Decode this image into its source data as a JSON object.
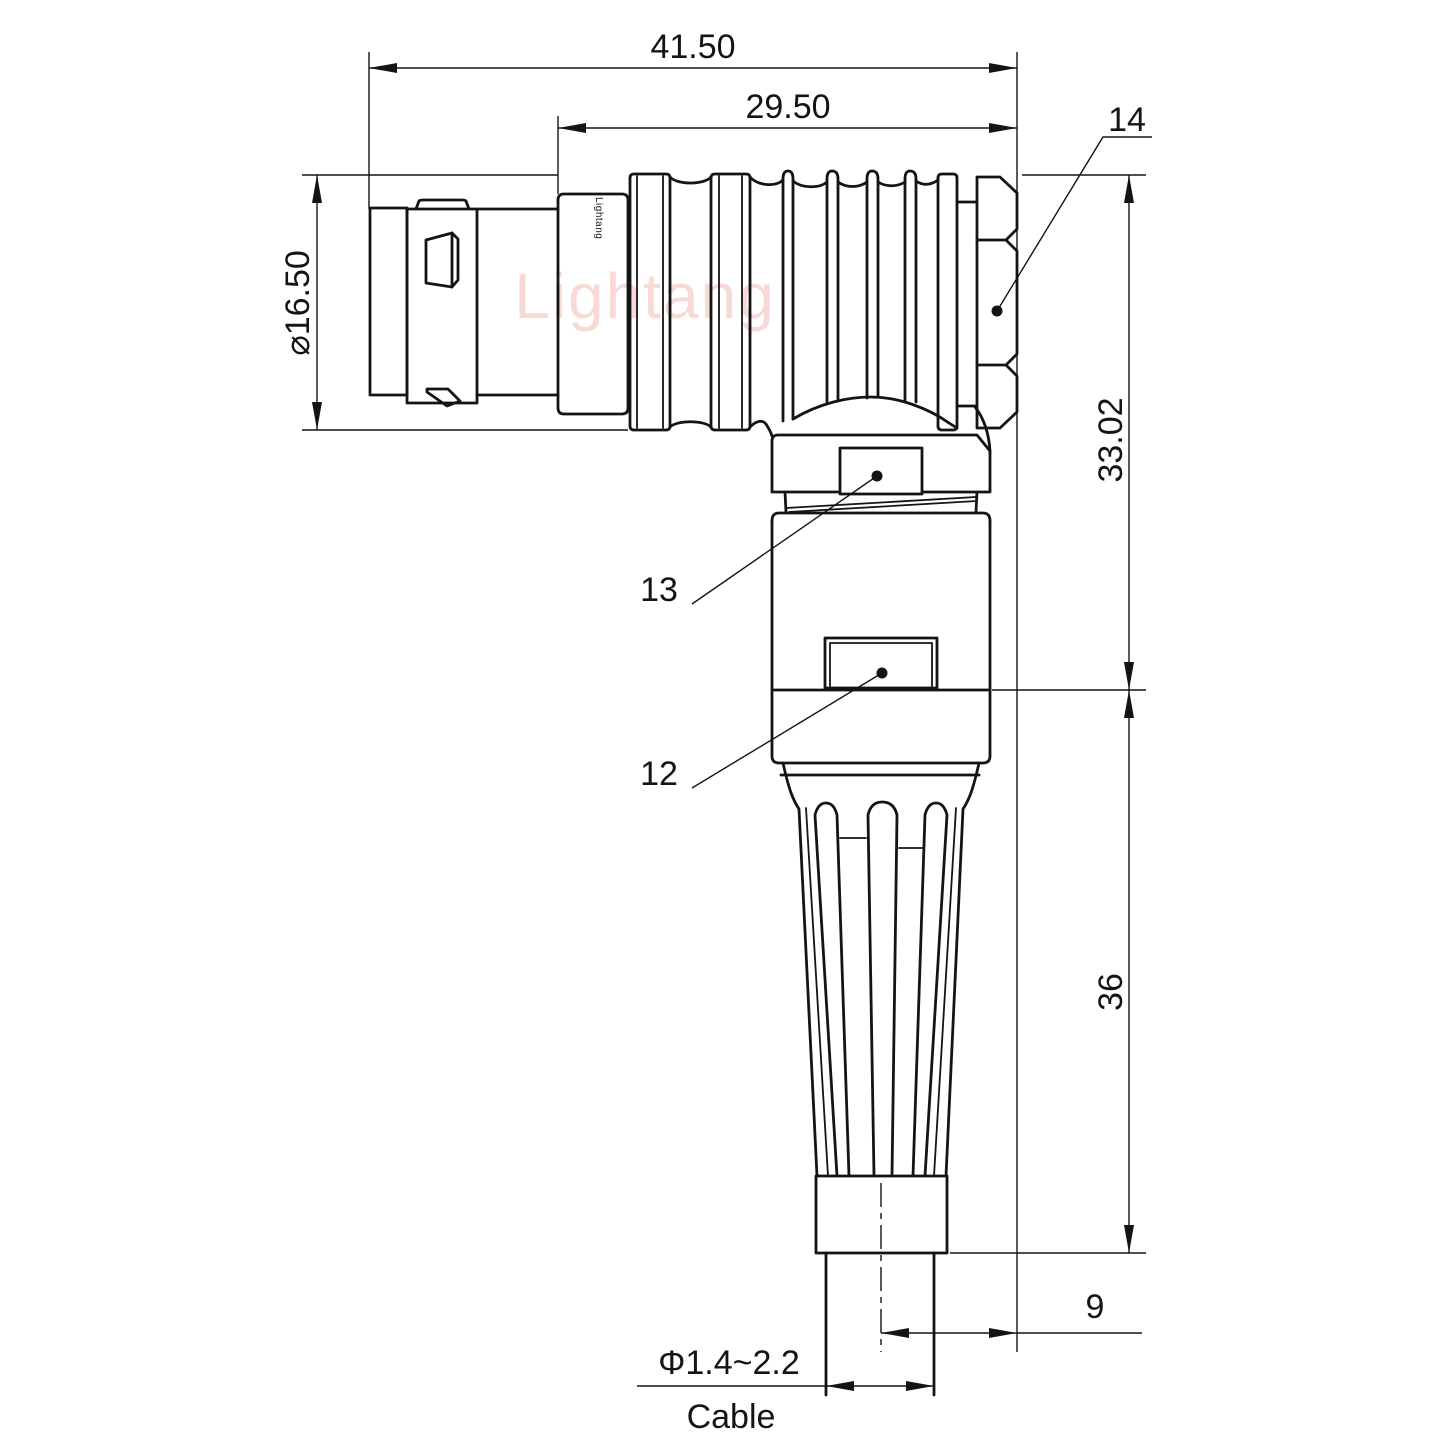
{
  "watermark": {
    "text": "Lightang"
  },
  "engraving": {
    "text": "Lightang"
  },
  "dims": {
    "overall_length": "41.50",
    "rear_length": "29.50",
    "plug_diameter": "⌀16.50",
    "upper_height": "33.02",
    "lower_height": "36",
    "cable_offset": "9",
    "cable_diameter": "Φ1.4~2.2",
    "cable_label": "Cable"
  },
  "labels": {
    "backnut": "14",
    "coupling_detent": "13",
    "housing_detent": "12"
  },
  "colors": {
    "line": "#141414",
    "watermark": "#e06a5e",
    "background": "#ffffff"
  }
}
